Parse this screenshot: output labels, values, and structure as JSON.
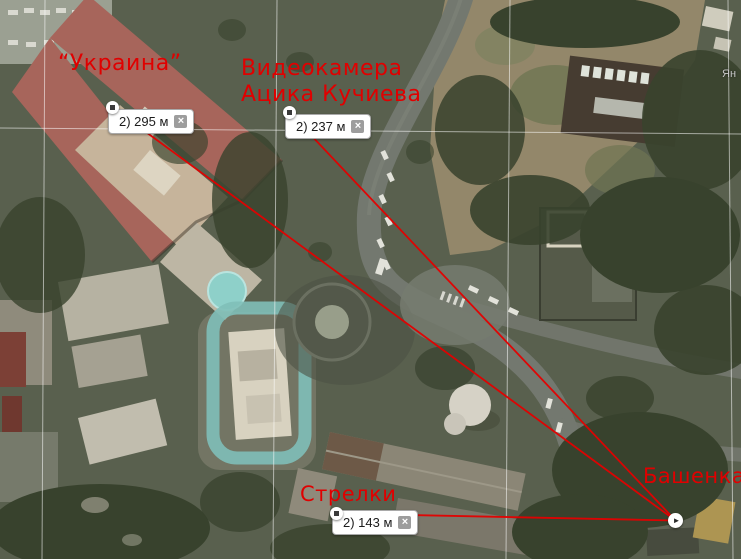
{
  "annotations": {
    "labels": {
      "ukraina": {
        "text": "“Украина”"
      },
      "videocamera": {
        "line1": "Видеокамера",
        "line2": "Ацика Кучиева"
      },
      "strelki": {
        "text": "Стрелки"
      },
      "bashenka": {
        "text": "Башенка"
      }
    }
  },
  "rulers": [
    {
      "measurement": "2) 295 м"
    },
    {
      "measurement": "2) 237 м"
    },
    {
      "measurement": "2) 143 м"
    }
  ],
  "controls": {
    "close_glyph": "×",
    "endpoint_glyph": "►"
  },
  "watermark": {
    "text": "Ян"
  },
  "colors": {
    "annotation_red": "#e00000",
    "ruler_line": "#e40000",
    "grid_line": "rgba(255,255,255,0.55)",
    "bubble_bg": "#ffffff",
    "bubble_border": "#a9a9a9",
    "close_button_bg": "#9d9d9d",
    "pool_teal": "#8ed0c9"
  }
}
